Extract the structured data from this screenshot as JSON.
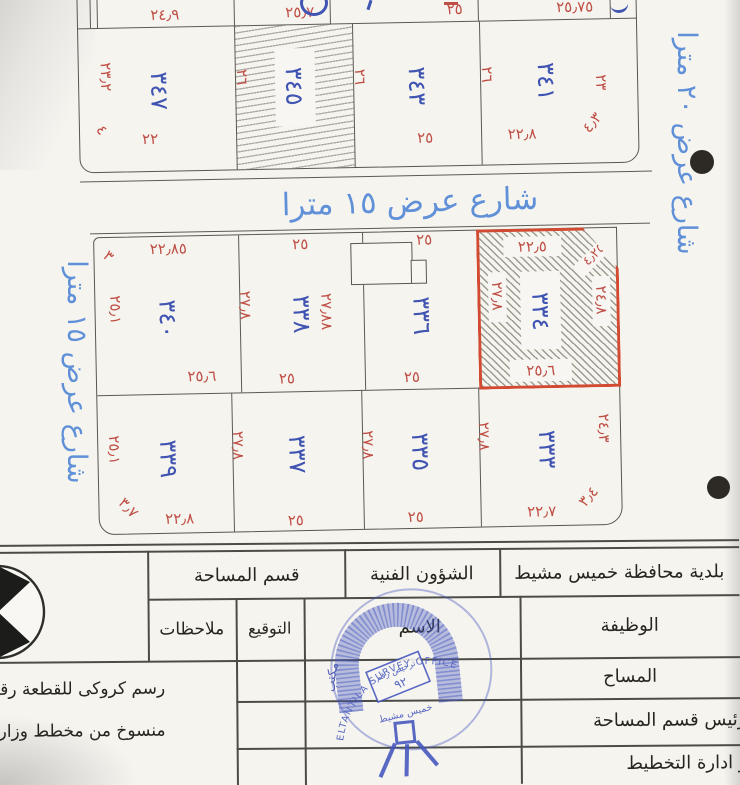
{
  "plan": {
    "streets": {
      "middle": "شارع عرض ١٥ مترا",
      "left": "شارع عرض ١٥ مترا",
      "right": "شارع عرض ٢٠ مترا"
    },
    "block1": {
      "top_dims": [
        "٢٤٫٩",
        "٢٥٫٧",
        "٢٥",
        "٢٥٫٧٥"
      ],
      "plot_numbers": [
        "٣٤٧",
        "٣٤٥",
        "٣٤٣",
        "٣٤١"
      ],
      "side_dims": [
        "٢٦",
        "٢٦",
        "٢٦"
      ],
      "left_dim": "٢٣٫٢",
      "left_corner_dim": "٤",
      "right_dim": "٢٣",
      "right_corner_dim": "٤٫٣",
      "bottom_dims": [
        "٢٢",
        "٢٥",
        "٢٢٫٨"
      ]
    },
    "block2": {
      "top_row": {
        "top_dims": [
          "٢٢٫٨٥",
          "٢٥",
          "٢٥"
        ],
        "corner_dim": "٣",
        "left_dim": "٢٥٫١",
        "plot_numbers": [
          "٣٤٠",
          "٣٣٨",
          "٣٣٦"
        ],
        "side_dims": [
          "٢٧٫٨",
          "٢٧٫٨٨"
        ],
        "bottom_dims": [
          "٢٥٫٦",
          "٢٥",
          "٢٥"
        ]
      },
      "highlight_plot": {
        "number": "٣٣٤",
        "top_dim": "٢٢٫٥",
        "corner_dim": "٤٫٢٥",
        "left_dim": "٢٧٫٨",
        "right_dim": "٢٤٫٨",
        "bottom_dim": "٢٥٫٦"
      },
      "bottom_row": {
        "left_dim": "٢٥٫١",
        "corner_left_dim": "٣٫٧",
        "plot_numbers": [
          "٣٣٩",
          "٣٣٧",
          "٣٣٥",
          "٣٣٣"
        ],
        "side_dims": [
          "٢٧٫٨",
          "٢٧٫٨",
          "٢٧٫٨"
        ],
        "right_dim": "٢٤٫٣",
        "corner_right_dim": "٣٫٤",
        "bottom_dims": [
          "٢٢٫٨",
          "٢٥",
          "٢٥",
          "٢٢٫٧"
        ]
      }
    }
  },
  "table": {
    "header": [
      "قسم المساحة",
      "الشؤون الفنية",
      "بلدية محافظة خميس مشيط"
    ],
    "columns": [
      "ملاحظات",
      "التوقيع",
      "الاسم",
      "الوظيفة"
    ],
    "roles": [
      "المساح",
      "رئيس قسم المساحة",
      "مدير ادارة التخطيط"
    ],
    "notes": [
      "رسم كروكى للقطعة رقم",
      "منسوخ من مخطط وزارة ال"
    ]
  },
  "stamp": {
    "arc_text": "مكتب الهيئة للمساحة",
    "license_line1": "ترخيص رقم",
    "license_line2": "٩٢",
    "city": "خميس مشيط",
    "english": "ELTANTILA SURVEY OFFICE"
  },
  "colors": {
    "plot_number_blue": "#4054b2",
    "dimension_red": "#bf4f45",
    "street_blue": "#6090d8",
    "stamp_blue": "#4355bd",
    "highlight_red": "#d24a32"
  }
}
